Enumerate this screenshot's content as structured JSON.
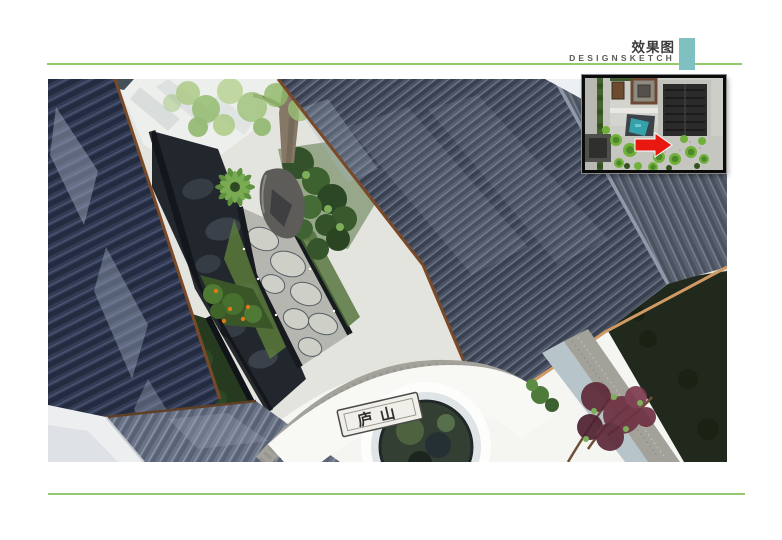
{
  "header": {
    "title_cn": "效果图",
    "title_en": "DESIGNSKETCH"
  },
  "main_render": {
    "plaque_text": "庐山"
  },
  "theme": {
    "page_bg": "#ffffff",
    "title_color": "#3c3c3c",
    "subtitle_color": "#5a5a5a",
    "accent_teal": "#7fc0c1",
    "rule_green": "#96c96f",
    "arrow_red": "#e81710",
    "water_teal": "#35a2ab"
  },
  "palette_reference": {
    "roof_dark_navy": "#28314a",
    "roof_mid_slate": "#4b5364",
    "roof_right_plane": "#59616f",
    "eave_brown": "#7a4a28",
    "eave_tan": "#cf9a63",
    "slate_paving": "#22272d",
    "flagstone": "#b5b6af",
    "lawn_dark_green": "#20291b",
    "moon_gate_wall": "#f5f5f2",
    "coping_gray": "#a2a19a",
    "flower_red": "#d42318",
    "shrub_purple": "#6e3143"
  }
}
